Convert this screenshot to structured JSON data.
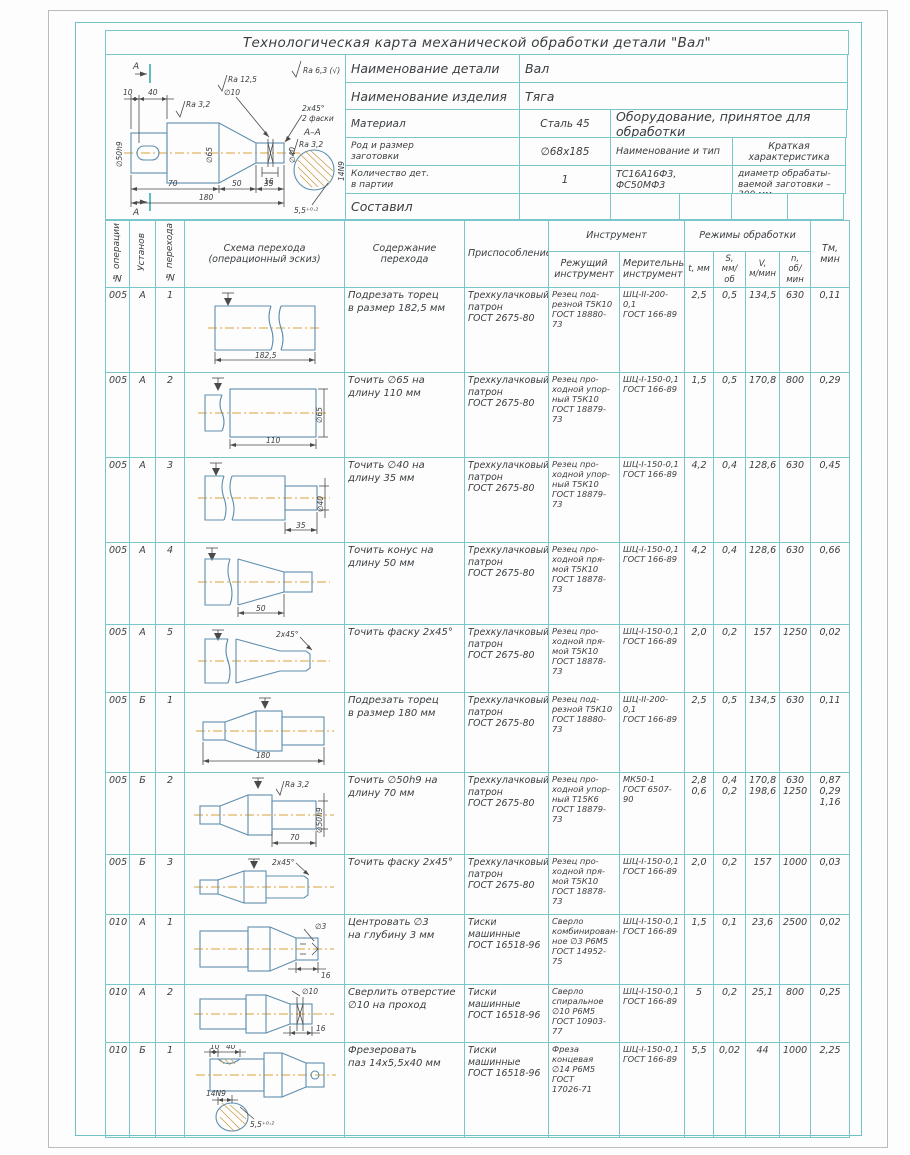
{
  "title": "Технологическая карта механической обработки детали \"Вал\"",
  "info": {
    "detail_label": "Наименование детали",
    "detail_value": "Вал",
    "product_label": "Наименование изделия",
    "product_value": "Тяга",
    "material_label": "Материал",
    "material_value": "Сталь 45",
    "equipment_header": "Оборудование, принятое для обработки",
    "blank_label": "Род и размер\nзаготовки",
    "blank_value": "∅68х185",
    "type_label": "Наименование и тип",
    "char_label": "Краткая характеристика",
    "qty_label": "Количество дет.\nв партии",
    "qty_value": "1",
    "machines": "ТС16А16Ф3, ФС50МФ3",
    "characteristic": "Наибольший диаметр обрабаты-\nваемой заготовки – 300 мм",
    "author_label": "Составил"
  },
  "drawing": {
    "labels": [
      "А",
      "А",
      "10",
      "40",
      "Ra 3,2",
      "Ra 12,5",
      "∅10",
      "Ra 6,3 (√)",
      "2х45°",
      "2 фаски",
      "∅50h9",
      "∅65",
      "∅40",
      "16",
      "70",
      "50",
      "35",
      "180",
      "А–А",
      "Ra 3,2",
      "5,5⁺⁰·²",
      "14N9"
    ]
  },
  "table": {
    "headers": {
      "op": "№ операции",
      "setup": "Установ",
      "step": "№ перехода",
      "sketch": "Схема перехода\n(операционный эскиз)",
      "content": "Содержание перехода",
      "fixture": "Приспособление",
      "tool": "Инструмент",
      "cutting": "Режущий\nинструмент",
      "measuring": "Мерительный\nинструмент",
      "modes": "Режимы обработки",
      "t": "t, мм",
      "s": "S,\nмм/об",
      "v": "V,\nм/мин",
      "n": "n,\nоб/мин",
      "tm": "Тм,\nмин"
    },
    "rows": [
      {
        "op": "005",
        "setup": "А",
        "step": "1",
        "content": "Подрезать торец\nв размер 182,5 мм",
        "fixture": "Трехкулачковый\nпатрон\nГОСТ 2675-80",
        "cutting": "Резец под-\nрезной Т5К10\nГОСТ 18880-\n73",
        "measuring": "ШЦ-II-200-0,1\nГОСТ 166-89",
        "t": "2,5",
        "s": "0,5",
        "v": "134,5",
        "n": "630",
        "tm": "0,11",
        "sketch": [
          "182,5"
        ]
      },
      {
        "op": "005",
        "setup": "А",
        "step": "2",
        "content": "Точить ∅65 на\nдлину 110 мм",
        "fixture": "Трехкулачковый\nпатрон\nГОСТ 2675-80",
        "cutting": "Резец про-\nходной упор-\nный Т5К10\nГОСТ 18879-\n73",
        "measuring": "ШЦ-I-150-0,1\nГОСТ 166-89",
        "t": "1,5",
        "s": "0,5",
        "v": "170,8",
        "n": "800",
        "tm": "0,29",
        "sketch": [
          "∅65",
          "110"
        ]
      },
      {
        "op": "005",
        "setup": "А",
        "step": "3",
        "content": "Точить ∅40 на\nдлину 35 мм",
        "fixture": "Трехкулачковый\nпатрон\nГОСТ 2675-80",
        "cutting": "Резец про-\nходной упор-\nный Т5К10\nГОСТ 18879-\n73",
        "measuring": "ШЦ-I-150-0,1\nГОСТ 166-89",
        "t": "4,2",
        "s": "0,4",
        "v": "128,6",
        "n": "630",
        "tm": "0,45",
        "sketch": [
          "∅40",
          "35"
        ]
      },
      {
        "op": "005",
        "setup": "А",
        "step": "4",
        "content": "Точить конус на\nдлину 50 мм",
        "fixture": "Трехкулачковый\nпатрон\nГОСТ 2675-80",
        "cutting": "Резец про-\nходной пря-\nмой Т5К10\nГОСТ 18878-\n73",
        "measuring": "ШЦ-I-150-0,1\nГОСТ 166-89",
        "t": "4,2",
        "s": "0,4",
        "v": "128,6",
        "n": "630",
        "tm": "0,66",
        "sketch": [
          "50"
        ]
      },
      {
        "op": "005",
        "setup": "А",
        "step": "5",
        "content": "Точить фаску 2х45°",
        "fixture": "Трехкулачковый\nпатрон\nГОСТ 2675-80",
        "cutting": "Резец про-\nходной пря-\nмой Т5К10\nГОСТ 18878-\n73",
        "measuring": "ШЦ-I-150-0,1\nГОСТ 166-89",
        "t": "2,0",
        "s": "0,2",
        "v": "157",
        "n": "1250",
        "tm": "0,02",
        "sketch": [
          "2х45°"
        ]
      },
      {
        "op": "005",
        "setup": "Б",
        "step": "1",
        "content": "Подрезать торец\nв размер 180 мм",
        "fixture": "Трехкулачковый\nпатрон\nГОСТ 2675-80",
        "cutting": "Резец под-\nрезной Т5К10\nГОСТ 18880-\n73",
        "measuring": "ШЦ-II-200-0,1\nГОСТ 166-89",
        "t": "2,5",
        "s": "0,5",
        "v": "134,5",
        "n": "630",
        "tm": "0,11",
        "sketch": [
          "180"
        ]
      },
      {
        "op": "005",
        "setup": "Б",
        "step": "2",
        "content": "Точить ∅50h9 на\nдлину 70 мм",
        "fixture": "Трехкулачковый\nпатрон\nГОСТ 2675-80",
        "cutting": "Резец про-\nходной упор-\nный Т15К6\nГОСТ 18879-\n73",
        "measuring": "МК50-1\nГОСТ 6507-90",
        "t": "2,8\n0,6",
        "s": "0,4\n0,2",
        "v": "170,8\n198,6",
        "n": "630\n1250",
        "tm": "0,87\n0,29\n1,16",
        "sketch": [
          "Ra 3,2",
          "∅50h9",
          "70"
        ]
      },
      {
        "op": "005",
        "setup": "Б",
        "step": "3",
        "content": "Точить фаску 2х45°",
        "fixture": "Трехкулачковый\nпатрон\nГОСТ 2675-80",
        "cutting": "Резец про-\nходной пря-\nмой Т5К10\nГОСТ 18878-\n73",
        "measuring": "ШЦ-I-150-0,1\nГОСТ 166-89",
        "t": "2,0",
        "s": "0,2",
        "v": "157",
        "n": "1000",
        "tm": "0,03",
        "sketch": [
          "2х45°"
        ]
      },
      {
        "op": "010",
        "setup": "А",
        "step": "1",
        "content": "Центровать ∅3\nна глубину 3 мм",
        "fixture": "Тиски\nмашинные\nГОСТ 16518-96",
        "cutting": "Сверло\nкомбинирован-\nное ∅3 Р6М5\nГОСТ 14952-75",
        "measuring": "ШЦ-I-150-0,1\nГОСТ 166-89",
        "t": "1,5",
        "s": "0,1",
        "v": "23,6",
        "n": "2500",
        "tm": "0,02",
        "sketch": [
          "∅3",
          "16"
        ]
      },
      {
        "op": "010",
        "setup": "А",
        "step": "2",
        "content": "Сверлить отверстие\n∅10 на проход",
        "fixture": "Тиски\nмашинные\nГОСТ 16518-96",
        "cutting": "Сверло\nспиральное\n∅10 Р6М5\nГОСТ 10903-\n77",
        "measuring": "ШЦ-I-150-0,1\nГОСТ 166-89",
        "t": "5",
        "s": "0,2",
        "v": "25,1",
        "n": "800",
        "tm": "0,25",
        "sketch": [
          "∅10",
          "16"
        ]
      },
      {
        "op": "010",
        "setup": "Б",
        "step": "1",
        "content": "Фрезеровать\nпаз 14х5,5х40 мм",
        "fixture": "Тиски\nмашинные\nГОСТ 16518-96",
        "cutting": "Фреза\nконцевая\n∅14 Р6М5\nГОСТ\n17026-71",
        "measuring": "ШЦ-I-150-0,1\nГОСТ 166-89",
        "t": "5,5",
        "s": "0,02",
        "v": "44",
        "n": "1000",
        "tm": "2,25",
        "sketch": [
          "10",
          "40",
          "14N9",
          "5,5⁺⁰·²"
        ]
      }
    ]
  }
}
